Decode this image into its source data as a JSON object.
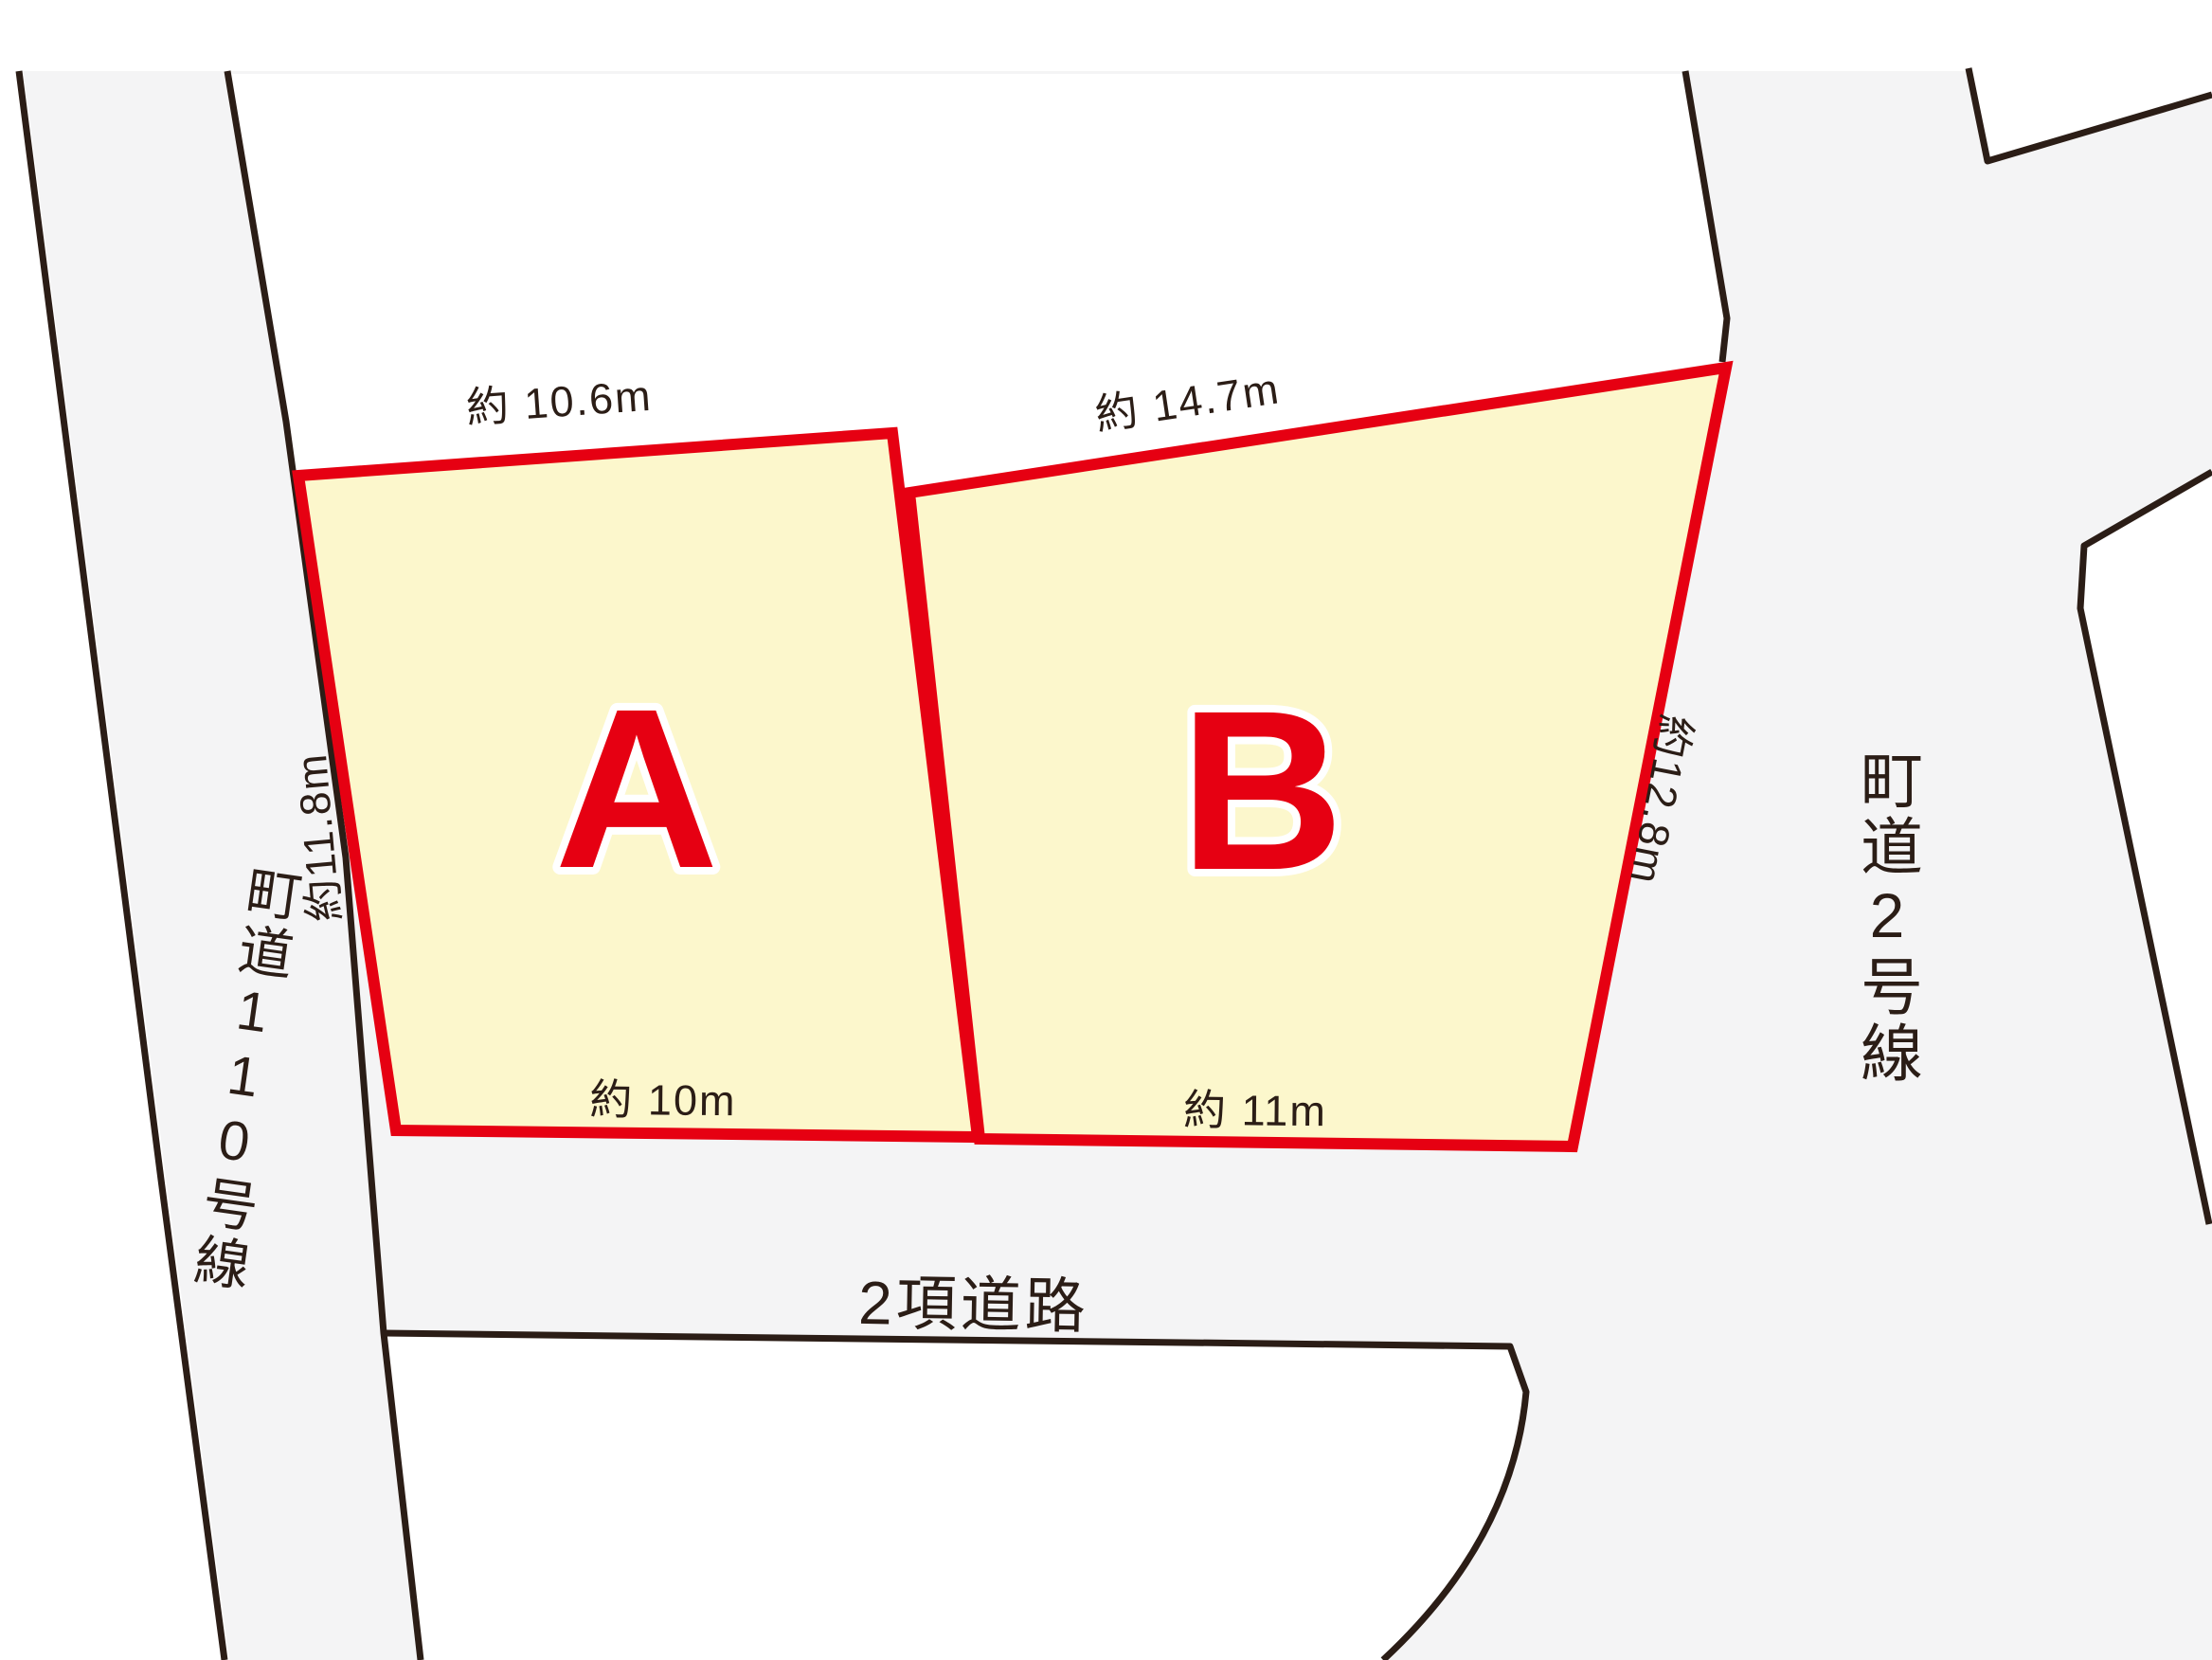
{
  "diagram_title": "land-lot-diagram",
  "lots": {
    "a": {
      "letter": "A",
      "dim_top": "約 10.6m",
      "dim_left": "約11.8m",
      "dim_bottom": "約 10m"
    },
    "b": {
      "letter": "B",
      "dim_top": "約 14.7m",
      "dim_right": "約12.8m",
      "dim_bottom": "約 11m"
    }
  },
  "roads": {
    "left": "町道110号線",
    "right": "町道2号線",
    "bottom": "2項道路"
  },
  "colors": {
    "lot_fill": "#FCF7CC",
    "lot_border": "#E60012",
    "lot_letter": "#E60012",
    "road_fill": "#F4F4F5",
    "line_black": "#2B1D16",
    "background": "#FFFFFF"
  }
}
